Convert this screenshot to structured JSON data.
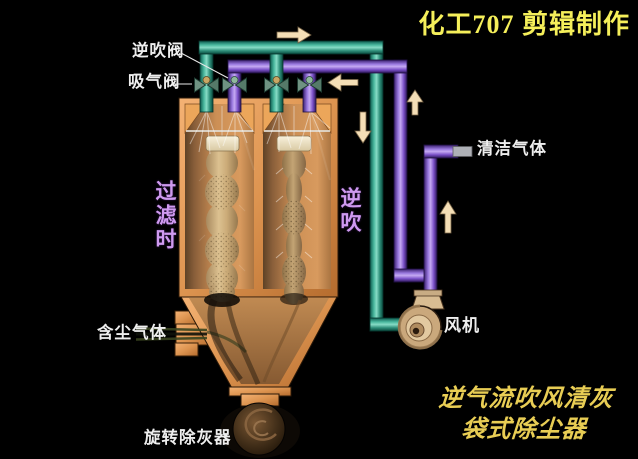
{
  "watermark": {
    "text": "化工707 剪辑制作"
  },
  "labels": {
    "reverse_blow_valve": "逆吹阀",
    "suction_valve": "吸气阀",
    "clean_gas": "清洁气体",
    "fan": "风机",
    "dusty_gas": "含尘气体",
    "rotary_ash_remover": "旋转除灰器",
    "filtering_state": "过滤时",
    "reverse_blowing_state": "逆吹"
  },
  "caption": {
    "line1": "逆气流吹风清灰",
    "line2": "袋式除尘器"
  },
  "flow_arrows": [
    {
      "name": "suction-header-flow",
      "direction": "right"
    },
    {
      "name": "reverse-blow-header-flow",
      "direction": "left"
    },
    {
      "name": "suction-downcomer-flow",
      "direction": "down"
    },
    {
      "name": "reverse-blow-riser-flow",
      "direction": "up"
    },
    {
      "name": "clean-gas-riser-flow",
      "direction": "up"
    }
  ],
  "colors": {
    "background": "#000000",
    "suction_pipe_teal": "#2f9a82",
    "reverse_blow_pipe_purple": "#8a5fd0",
    "vessel_orange": "#d98f4f",
    "filter_bag_tan": "#c9ab7d",
    "arrow_cream": "#f4deb6",
    "watermark_yellow": "#f5ef5a",
    "caption_yellow": "#e8cd54",
    "state_label_purple": "#cf9af0",
    "label_white": "#eeeeee"
  }
}
